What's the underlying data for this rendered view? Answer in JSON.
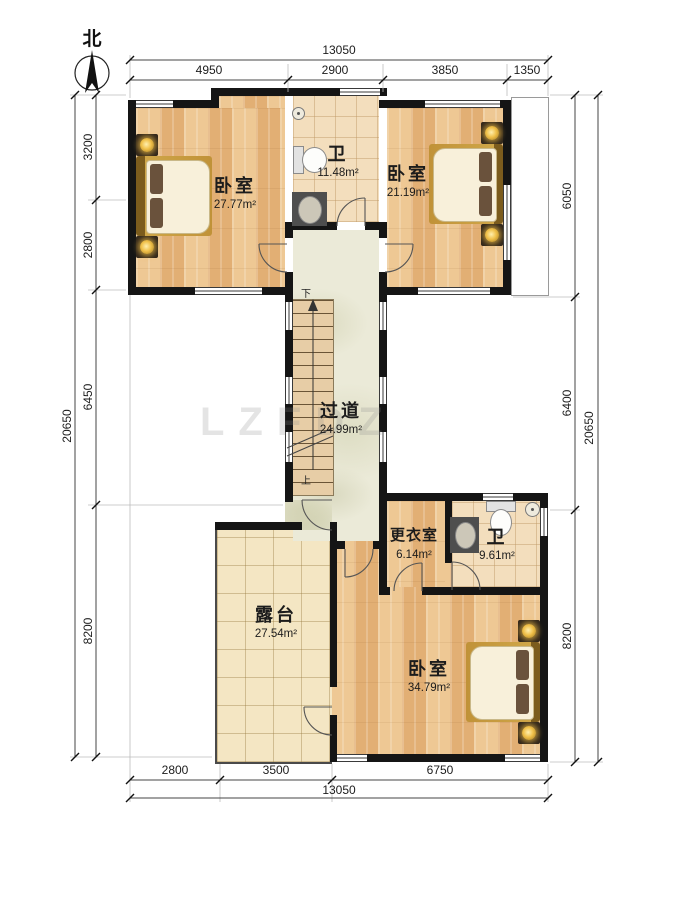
{
  "compass": {
    "label": "北"
  },
  "rooms": [
    {
      "name": "卧室",
      "area": "27.77m²"
    },
    {
      "name": "卫",
      "area": "11.48m²"
    },
    {
      "name": "卧室",
      "area": "21.19m²"
    },
    {
      "name": "过道",
      "area": "24.99m²"
    },
    {
      "name": "更衣室",
      "area": "6.14m²"
    },
    {
      "name": "卫",
      "area": "9.61m²"
    },
    {
      "name": "露台",
      "area": "27.54m²"
    },
    {
      "name": "卧室",
      "area": "34.79m²"
    }
  ],
  "stairs": {
    "down": "下",
    "up": "上"
  },
  "dims": {
    "top": {
      "overall": "13050",
      "segments": [
        "4950",
        "2900",
        "3850",
        "1350"
      ]
    },
    "bottom": {
      "overall": "13050",
      "segments": [
        "2800",
        "3500",
        "6750"
      ]
    },
    "left": {
      "overall": "20650",
      "segments": [
        "3200",
        "2800",
        "6450",
        "8200"
      ]
    },
    "right": {
      "overall": "20650",
      "segments": [
        "6050",
        "6400",
        "8200"
      ]
    }
  },
  "watermark": "LZFDZ",
  "colors": {
    "wall": "#151515",
    "wood": "#e9bd85",
    "tile": "#f3debd",
    "corridor": "#ebead8",
    "terrace": "#f4e6c3",
    "gold": "#cfa648"
  }
}
